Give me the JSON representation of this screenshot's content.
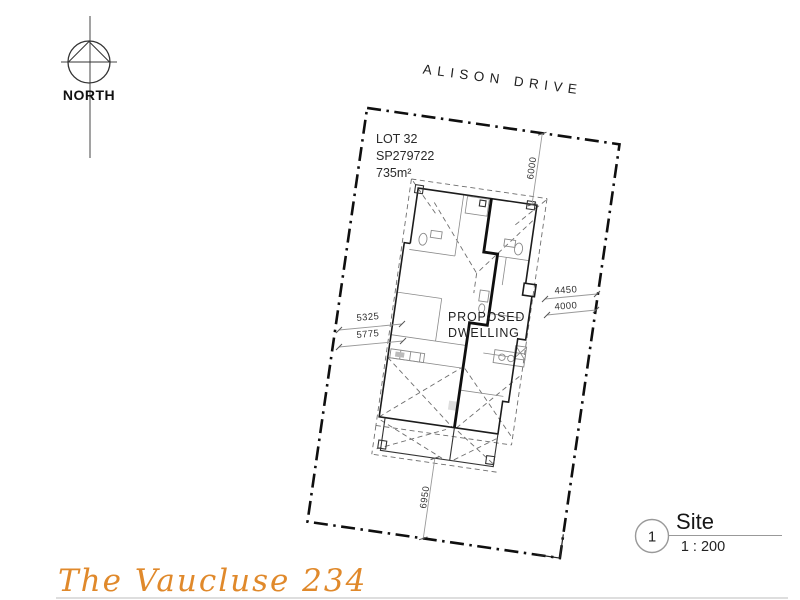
{
  "drawing": {
    "north_label": "NORTH",
    "street_name": "ALISON DRIVE",
    "lot": {
      "number": "LOT 32",
      "plan": "SP279722",
      "area": "735m²"
    },
    "dwelling_label": {
      "line1": "PROPOSED",
      "line2": "DWELLING"
    },
    "dimensions": {
      "front_setback": "6000",
      "side_right_upper": "4450",
      "side_right_lower": "4000",
      "side_left_upper": "5325",
      "side_left_lower": "5775",
      "rear_setback": "6950"
    },
    "title_block": {
      "sheet_number": "1",
      "title": "Site",
      "scale": "1 : 200"
    },
    "signature": "The Vaucluse 234"
  },
  "colors": {
    "accent_orange": "#E0892B",
    "line_black": "#0f0f0f",
    "line_gray": "#8a8a8a"
  }
}
